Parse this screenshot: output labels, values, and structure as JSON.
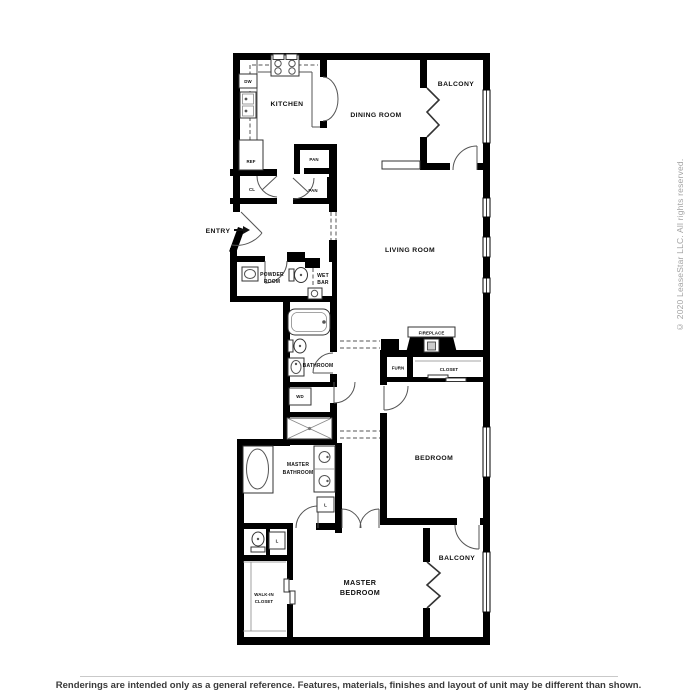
{
  "sidebar": {
    "copyright": "© 2020 LeaseStar LLC. All rights reserved."
  },
  "footer": {
    "disclaimer": "Renderings are intended only as a general reference. Features, materials, finishes and layout of unit may be different than shown."
  },
  "plan": {
    "rooms": {
      "kitchen": "KITCHEN",
      "dining_room": "DINING ROOM",
      "balcony_top": "BALCONY",
      "living_room": "LIVING ROOM",
      "entry": "ENTRY",
      "powder_room_1": "POWDER",
      "powder_room_2": "ROOM",
      "wet_bar_1": "WET",
      "wet_bar_2": "BAR",
      "bathroom": "BATHROOM",
      "closet": "CLOSET",
      "bedroom": "BEDROOM",
      "master_bathroom_1": "MASTER",
      "master_bathroom_2": "BATHROOM",
      "master_bedroom_1": "MASTER",
      "master_bedroom_2": "BEDROOM",
      "balcony_bottom": "BALCONY",
      "walk_in_closet_1": "WALK-IN",
      "walk_in_closet_2": "CLOSET"
    },
    "fixtures": {
      "dw": "DW",
      "ref": "REF",
      "cl": "CL",
      "pan_upper": "PAN",
      "pan_lower": "PAN",
      "wd": "WD",
      "furn": "FURN",
      "fireplace": "FIREPLACE",
      "linen_1": "L",
      "linen_2": "L"
    }
  }
}
